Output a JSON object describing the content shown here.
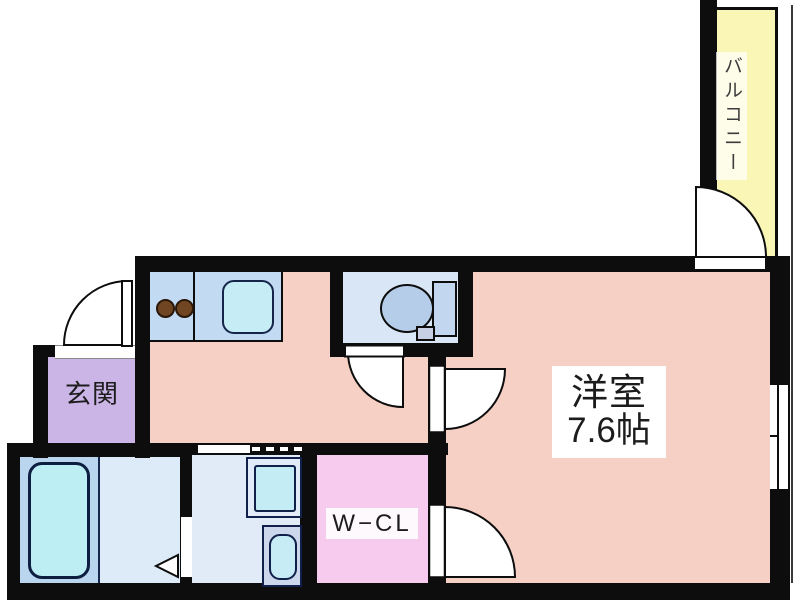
{
  "labels": {
    "balcony": "バルコニー",
    "room_name": "洋室",
    "room_size": "7.6帖",
    "entrance": "玄関",
    "closet": "W−CL"
  },
  "colors": {
    "wall": "#0d0d0d",
    "floor": "#f7d0c5",
    "entrance_bg": "#cab5e6",
    "balcony_bg": "#faf6b5",
    "counter": "#c2daf2",
    "sink": "#c6ecf6",
    "toilet_room": "#d9e6f6",
    "toilet_bowl": "#b6cdea",
    "toilet_tank": "#c2d6f0",
    "toilet_box": "#c6cfe3",
    "bath": "#b9d6ee",
    "bath_floor": "#dcebf7",
    "bathtub": "#bdeef4",
    "washroom": "#e0ebf7",
    "machine": "#c3ecf5",
    "vanity": "#cdd7eb",
    "vanity_bowl": "#c7ecf5",
    "closet_bg": "#f6cbee",
    "burner": "#6f4522"
  }
}
